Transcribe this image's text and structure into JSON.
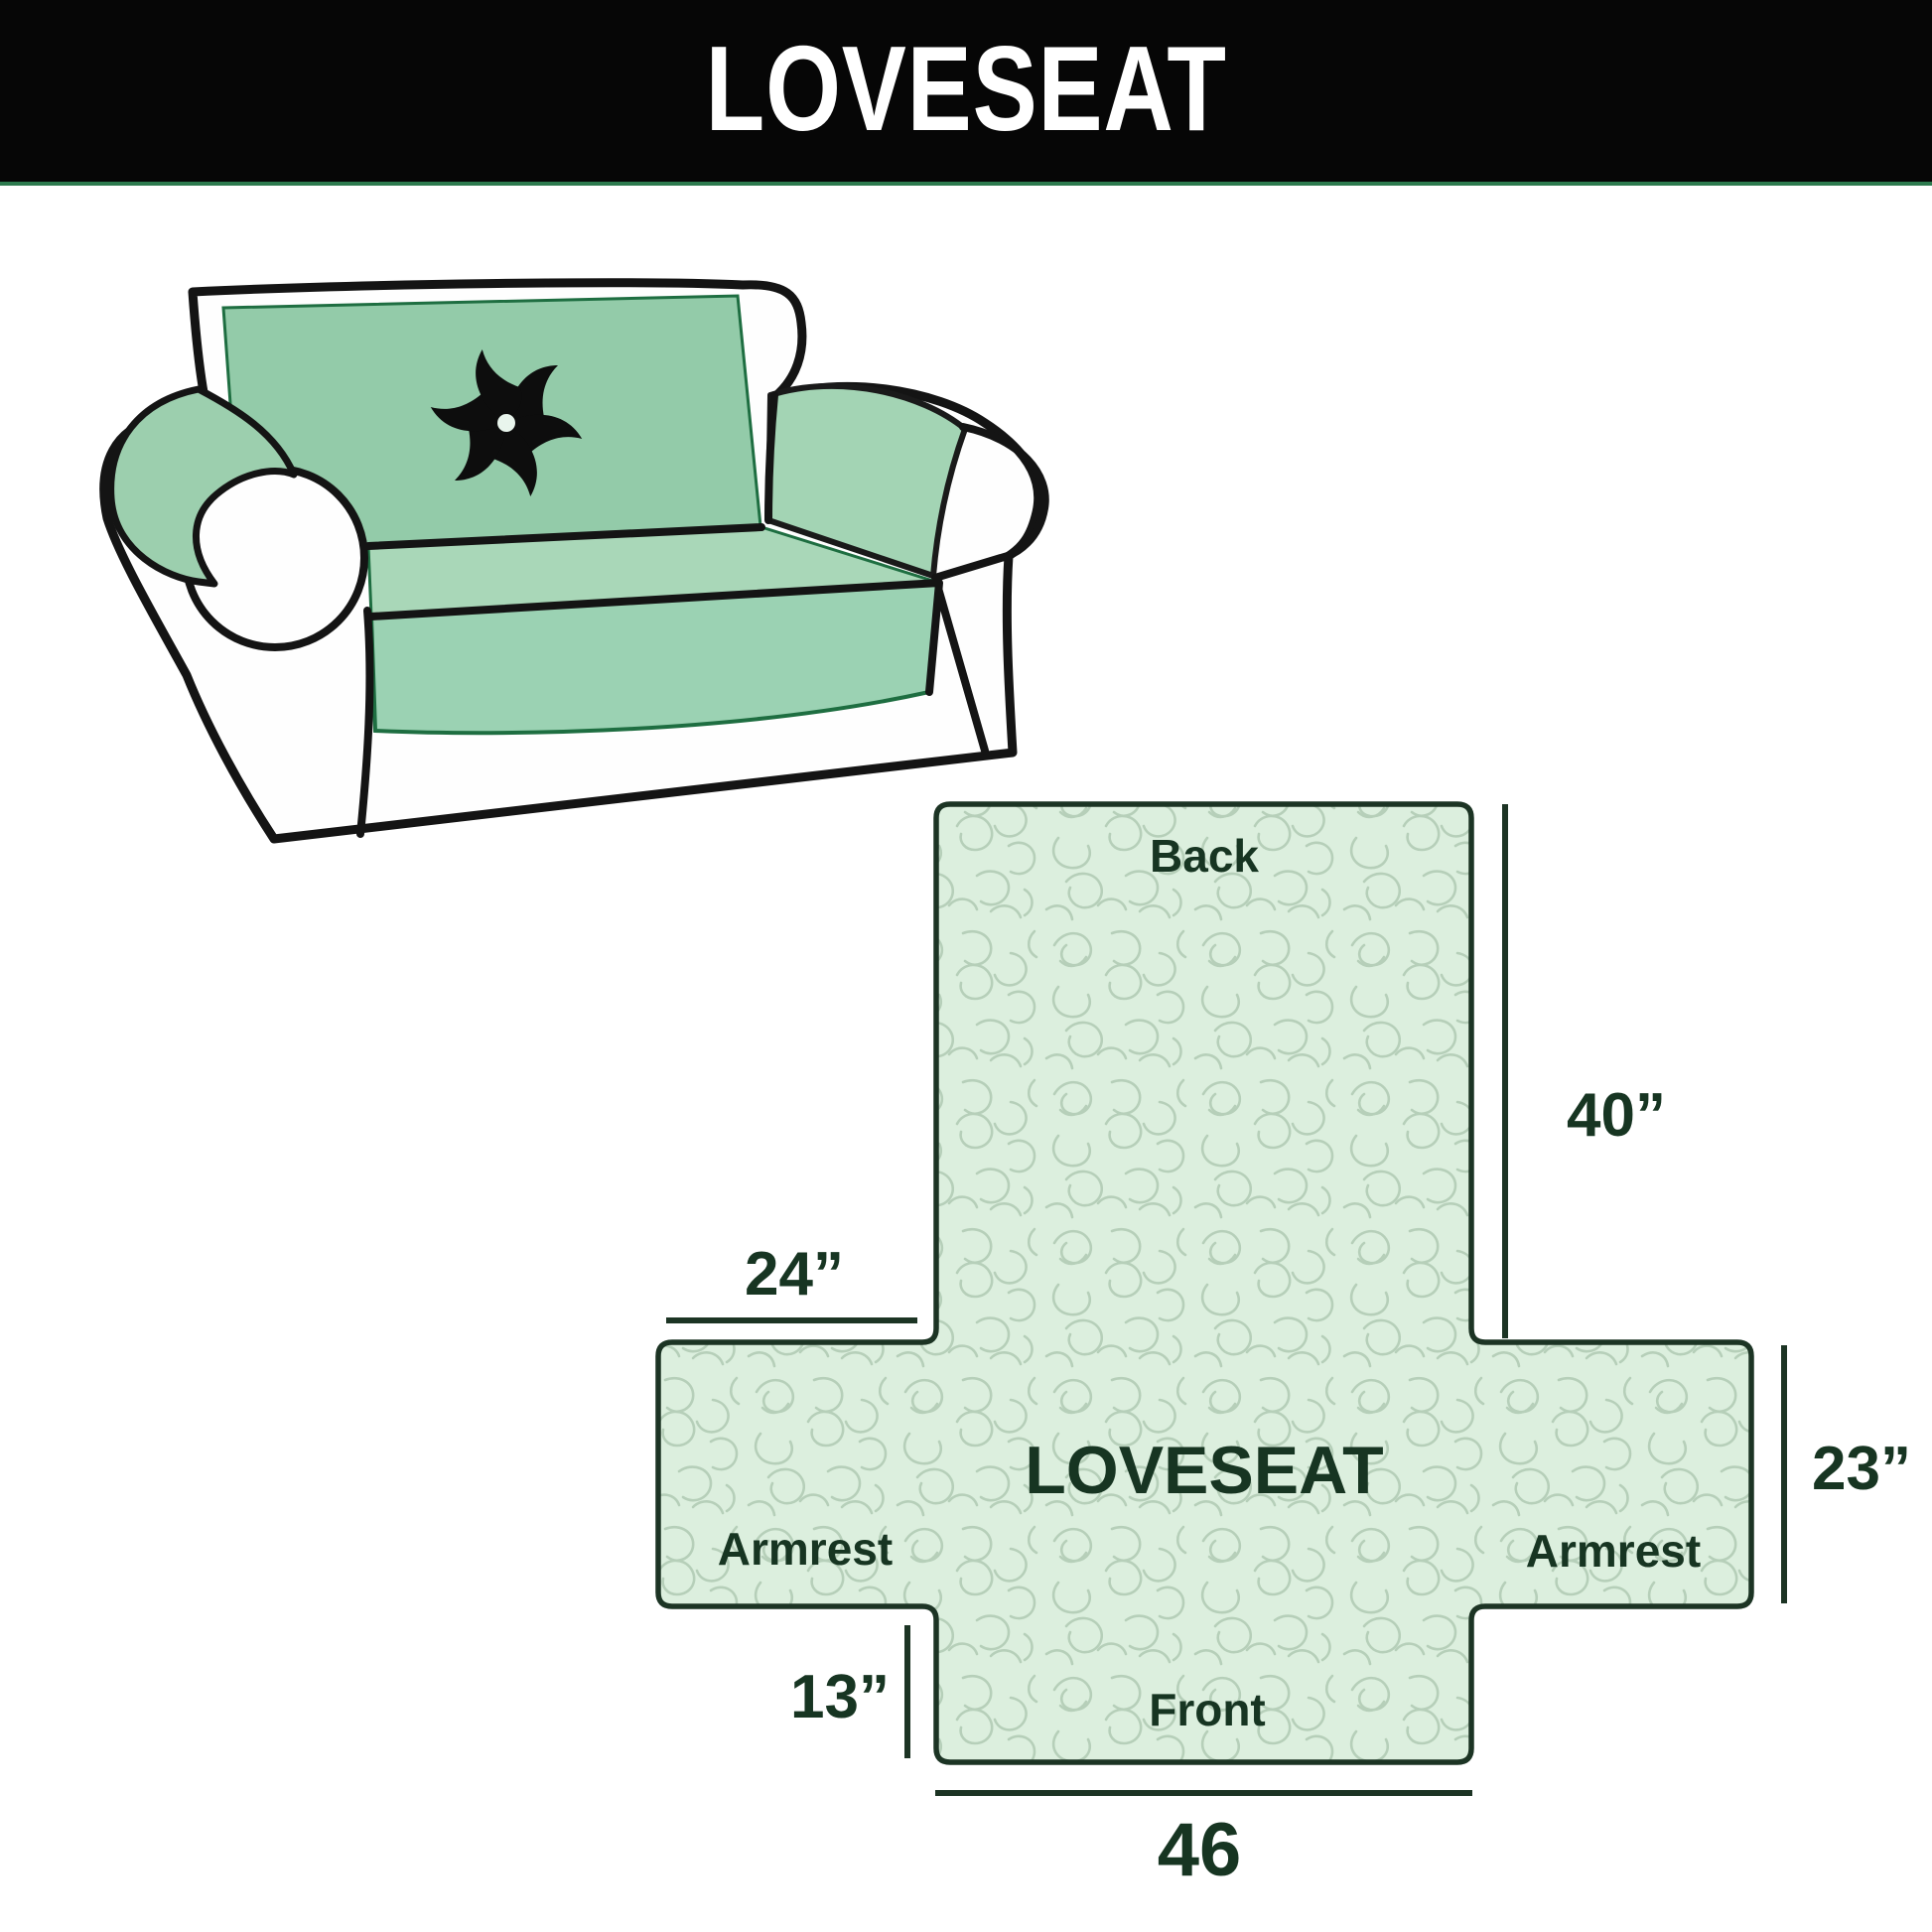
{
  "header": {
    "title": "LOVESEAT",
    "bar_color": "#060606",
    "title_color": "#ffffff"
  },
  "illustration": {
    "description": "loveseat sofa with quilted slip cover",
    "cover_color": "#95cdaa",
    "outline_color": "#141414",
    "logo_icon": "pinwheel-fan-icon"
  },
  "diagram": {
    "product_label": "LOVESEAT",
    "sections": {
      "back": "Back",
      "front": "Front",
      "armrest_left": "Armrest",
      "armrest_right": "Armrest"
    },
    "measurements": {
      "back_height": "40”",
      "armrest_top_width": "24”",
      "armrest_height": "23”",
      "front_drop": "13”",
      "front_width": "46"
    },
    "fill_color": "#dcefde",
    "texture_color": "#b6cfb9",
    "outline_color": "#1c3424",
    "text_color": "#173522"
  }
}
